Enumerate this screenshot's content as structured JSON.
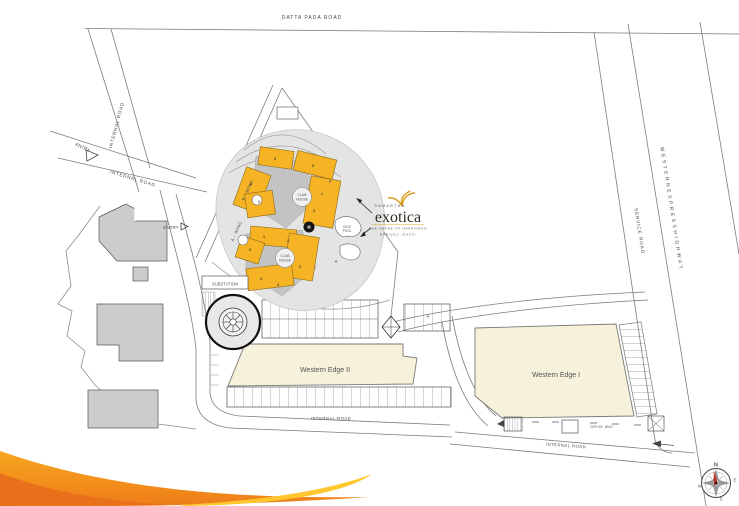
{
  "roads": {
    "datta_pada": "DATTA PADA ROAD",
    "internal": "INTERNAL ROAD",
    "service": "SERVICE ROAD",
    "western_express": "W E S T E R N   E X P R E S S   H I G H W A Y",
    "drive_way": "DRIVE WAY",
    "entry": "ENTRY"
  },
  "site": {
    "substation": "SUBSTATION",
    "a_wing": "A - WING",
    "b_wing": "B - WING",
    "club": "CLUB",
    "house": "HOUSE",
    "kids": "KIDS",
    "pool": "POOL",
    "western_edge_2": "Western Edge II",
    "western_edge_1": "Western Edge I",
    "upper_numbers": [
      "3",
      "3",
      "4",
      "2",
      "1",
      "2"
    ],
    "lower_numbers": [
      "1",
      "2",
      "3",
      "2",
      "4",
      "3"
    ],
    "tree": "✳"
  },
  "logo": {
    "brand": "SAMARTHA",
    "name": "exotica",
    "tagline": "THE ABODE OF HAPPINESS",
    "location": "BORIVALI (EAST)"
  },
  "compass": {
    "n": "N",
    "e": "E",
    "s": "S",
    "w": "W"
  },
  "colors": {
    "building_yellow": "#f6b324",
    "building_cream": "#f6f1da",
    "platform_gray": "#e4e4e4",
    "existing_gray": "#cccccc",
    "swoosh_orange": "#f49a1c",
    "swoosh_deep": "#e8701a",
    "swoosh_yellow": "#ffc62e",
    "logo_gold": "#c8961e",
    "needle_red": "#c62b1e"
  }
}
